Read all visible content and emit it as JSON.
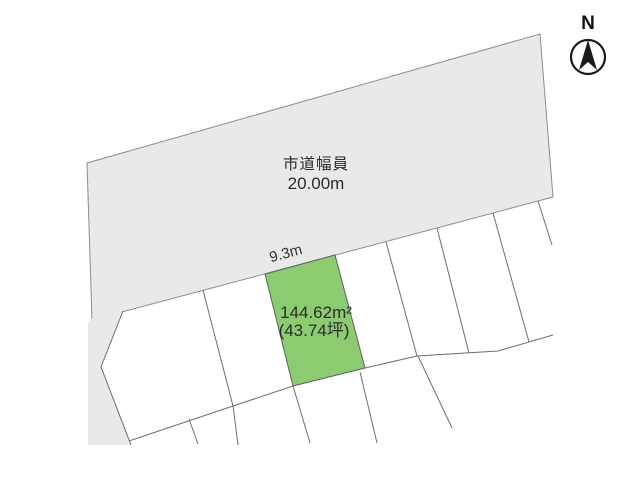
{
  "map": {
    "road": {
      "label_line1": "市道幅員",
      "label_line2": "20.00m"
    },
    "lot": {
      "frontage": "9.3m",
      "area_m2": "144.62m²",
      "area_tsubo": "(43.74坪)"
    },
    "compass": {
      "label": "N"
    }
  },
  "colors": {
    "road_fill": "#e9e9e7",
    "lot_fill": "#8dcb70",
    "parcel_line": "#6e6e6e",
    "text": "#2b2b2b"
  }
}
